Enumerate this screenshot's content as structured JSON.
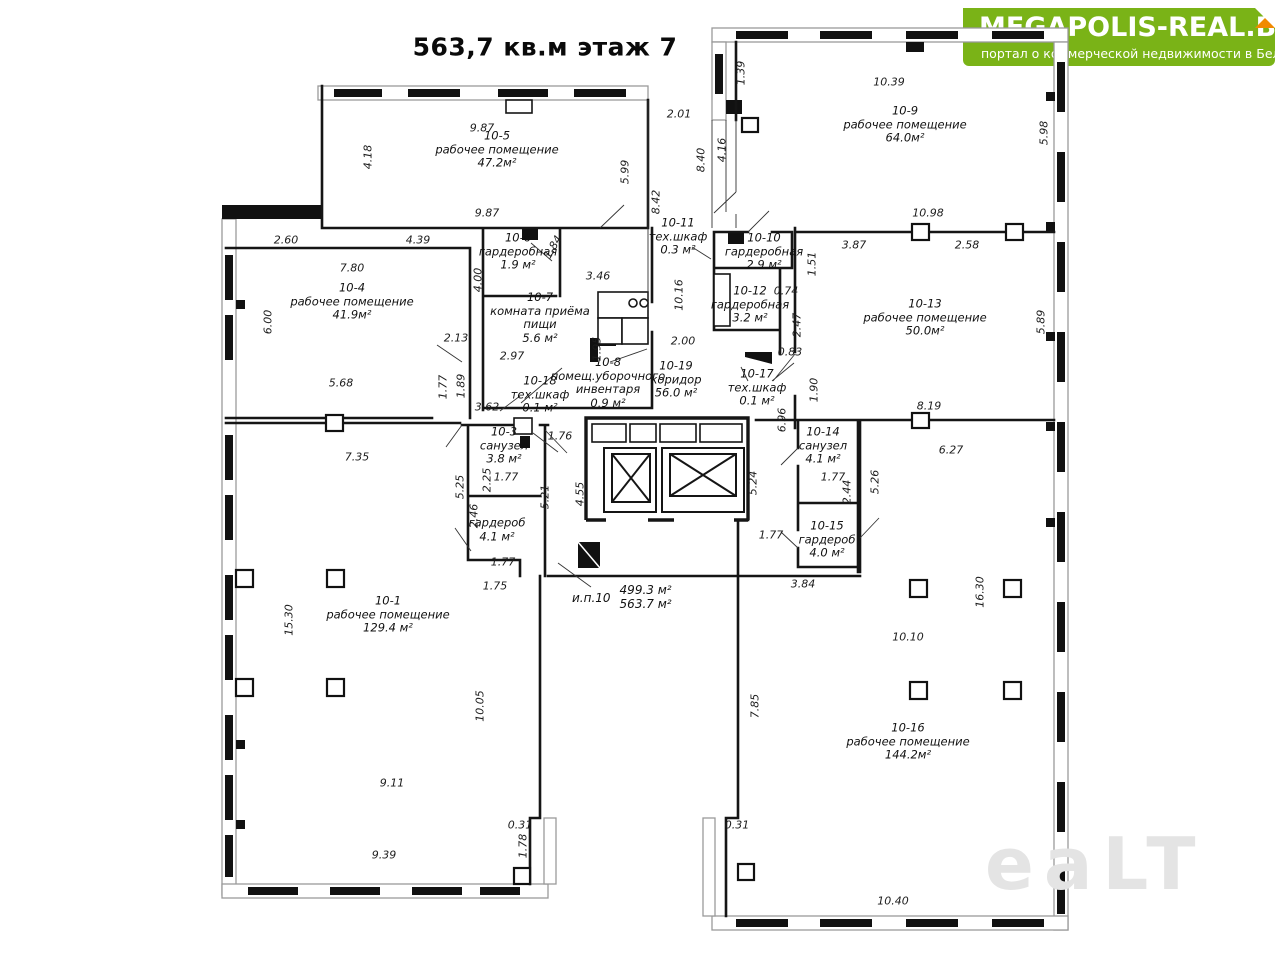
{
  "title": "563,7 кв.м этаж 7",
  "logo": {
    "name": "MEGAPOLIS-REAL.BY",
    "tagline": "портал о коммерческой недвижимости в Беларуси",
    "bg_color": "#7ab317",
    "fold_color": "#f18a00",
    "text_color": "#ffffff"
  },
  "watermark": "eaLT",
  "colors": {
    "wall": "#151515",
    "window_band": "#9a9a9a",
    "watermark_gray": "#e4e4e4"
  },
  "plan": {
    "total": {
      "id": "и.п.10",
      "area_upper": "499.3 м²",
      "area_lower": "563.7 м²"
    },
    "rooms": [
      {
        "id": "10-1",
        "name": "рабочее помещение",
        "area": "129.4 м²",
        "x": 388,
        "y": 615
      },
      {
        "id": "",
        "name": "гардероб",
        "area": "4.1 м²",
        "x": 497,
        "y": 530
      },
      {
        "id": "10-3",
        "name": "санузел",
        "area": "3.8 м²",
        "x": 504,
        "y": 446
      },
      {
        "id": "10-4",
        "name": "рабочее помещение",
        "area": "41.9м²",
        "x": 352,
        "y": 302
      },
      {
        "id": "10-5",
        "name": "рабочее помещение",
        "area": "47.2м²",
        "x": 497,
        "y": 150
      },
      {
        "id": "10-6",
        "name": "гардеробная",
        "area": "1.9 м²",
        "x": 518,
        "y": 252
      },
      {
        "id": "10-7",
        "name": "комната приёма пищи",
        "area": "5.6 м²",
        "x": 540,
        "y": 318,
        "w": 118
      },
      {
        "id": "10-8",
        "name": "помещ.уборочного инвентаря",
        "area": "0.9 м²",
        "x": 608,
        "y": 383,
        "w": 140
      },
      {
        "id": "10-9",
        "name": "рабочее помещение",
        "area": "64.0м²",
        "x": 905,
        "y": 125
      },
      {
        "id": "10-10",
        "name": "гардеробная",
        "area": "2.9 м²",
        "x": 764,
        "y": 252
      },
      {
        "id": "10-11",
        "name": "тех.шкаф",
        "area": "0.3 м²",
        "x": 678,
        "y": 237
      },
      {
        "id": "10-12",
        "name": "гардеробная",
        "area": "3.2 м²",
        "x": 750,
        "y": 305
      },
      {
        "id": "10-13",
        "name": "рабочее помещение",
        "area": "50.0м²",
        "x": 925,
        "y": 318
      },
      {
        "id": "10-14",
        "name": "санузел",
        "area": "4.1 м²",
        "x": 823,
        "y": 446
      },
      {
        "id": "10-15",
        "name": "гардероб",
        "area": "4.0 м²",
        "x": 827,
        "y": 540
      },
      {
        "id": "10-16",
        "name": "рабочее помещение",
        "area": "144.2м²",
        "x": 908,
        "y": 742
      },
      {
        "id": "10-17",
        "name": "тех.шкаф",
        "area": "0.1 м²",
        "x": 757,
        "y": 388
      },
      {
        "id": "10-18",
        "name": "тех.шкаф",
        "area": "0.1 м²",
        "x": 540,
        "y": 395
      },
      {
        "id": "10-19",
        "name": "коридор",
        "area": "56.0 м²",
        "x": 676,
        "y": 380
      }
    ],
    "dimensions": [
      {
        "v": "9.87",
        "x": 482,
        "y": 128,
        "r": 0
      },
      {
        "v": "9.87",
        "x": 487,
        "y": 213,
        "r": 0
      },
      {
        "v": "2.60",
        "x": 286,
        "y": 240,
        "r": 0
      },
      {
        "v": "4.39",
        "x": 418,
        "y": 240,
        "r": 0
      },
      {
        "v": "7.80",
        "x": 352,
        "y": 268,
        "r": 0
      },
      {
        "v": "2.13",
        "x": 456,
        "y": 338,
        "r": 0
      },
      {
        "v": "2.97",
        "x": 512,
        "y": 356,
        "r": 0
      },
      {
        "v": "3.46",
        "x": 598,
        "y": 276,
        "r": 0
      },
      {
        "v": "5.68",
        "x": 341,
        "y": 383,
        "r": 0
      },
      {
        "v": "3.62",
        "x": 487,
        "y": 407,
        "r": 0
      },
      {
        "v": "7.35",
        "x": 357,
        "y": 457,
        "r": 0
      },
      {
        "v": "2.00",
        "x": 683,
        "y": 341,
        "r": 0
      },
      {
        "v": "2.01",
        "x": 679,
        "y": 114,
        "r": 0
      },
      {
        "v": "10.39",
        "x": 889,
        "y": 82,
        "r": 0
      },
      {
        "v": "10.98",
        "x": 928,
        "y": 213,
        "r": 0
      },
      {
        "v": "3.87",
        "x": 854,
        "y": 245,
        "r": 0
      },
      {
        "v": "2.58",
        "x": 967,
        "y": 245,
        "r": 0
      },
      {
        "v": "0.74",
        "x": 786,
        "y": 291,
        "r": 0
      },
      {
        "v": "0.83",
        "x": 790,
        "y": 352,
        "r": 0
      },
      {
        "v": "8.19",
        "x": 929,
        "y": 406,
        "r": 0
      },
      {
        "v": "6.27",
        "x": 951,
        "y": 450,
        "r": 0
      },
      {
        "v": "1.76",
        "x": 560,
        "y": 436,
        "r": 0
      },
      {
        "v": "1.77",
        "x": 506,
        "y": 477,
        "r": 0
      },
      {
        "v": "1.77",
        "x": 503,
        "y": 562,
        "r": 0
      },
      {
        "v": "1.75",
        "x": 495,
        "y": 586,
        "r": 0
      },
      {
        "v": "1.77",
        "x": 833,
        "y": 477,
        "r": 0
      },
      {
        "v": "1.77",
        "x": 771,
        "y": 535,
        "r": 0
      },
      {
        "v": "3.84",
        "x": 803,
        "y": 584,
        "r": 0
      },
      {
        "v": "9.11",
        "x": 392,
        "y": 783,
        "r": 0
      },
      {
        "v": "9.39",
        "x": 384,
        "y": 855,
        "r": 0
      },
      {
        "v": "0.31",
        "x": 520,
        "y": 825,
        "r": 0
      },
      {
        "v": "0.31",
        "x": 737,
        "y": 825,
        "r": 0
      },
      {
        "v": "10.10",
        "x": 908,
        "y": 637,
        "r": 0
      },
      {
        "v": "10.40",
        "x": 893,
        "y": 901,
        "r": 0
      },
      {
        "v": "4.18",
        "x": 368,
        "y": 157,
        "r": 1
      },
      {
        "v": "5.99",
        "x": 625,
        "y": 172,
        "r": 1
      },
      {
        "v": "6.00",
        "x": 268,
        "y": 322,
        "r": 1
      },
      {
        "v": "4.00",
        "x": 478,
        "y": 280,
        "r": 1
      },
      {
        "v": "1.95",
        "x": 597,
        "y": 349,
        "r": 1
      },
      {
        "v": "1.89",
        "x": 461,
        "y": 386,
        "r": 1
      },
      {
        "v": "1.77",
        "x": 443,
        "y": 387,
        "r": 1
      },
      {
        "v": "10.16",
        "x": 679,
        "y": 295,
        "r": 1
      },
      {
        "v": "1.39",
        "x": 741,
        "y": 73,
        "r": 1
      },
      {
        "v": "8.40",
        "x": 701,
        "y": 160,
        "r": 1
      },
      {
        "v": "4.16",
        "x": 722,
        "y": 150,
        "r": 1
      },
      {
        "v": "8.42",
        "x": 656,
        "y": 202,
        "r": 1
      },
      {
        "v": "5.98",
        "x": 1044,
        "y": 133,
        "r": 1
      },
      {
        "v": "1.51",
        "x": 812,
        "y": 264,
        "r": 1
      },
      {
        "v": "2.47",
        "x": 797,
        "y": 325,
        "r": 1
      },
      {
        "v": "1.90",
        "x": 814,
        "y": 390,
        "r": 1
      },
      {
        "v": "5.89",
        "x": 1041,
        "y": 322,
        "r": 1
      },
      {
        "v": "6.96",
        "x": 782,
        "y": 420,
        "r": 1
      },
      {
        "v": "2.25",
        "x": 487,
        "y": 480,
        "r": 1
      },
      {
        "v": "5.25",
        "x": 460,
        "y": 487,
        "r": 1
      },
      {
        "v": "2.46",
        "x": 474,
        "y": 516,
        "r": 1
      },
      {
        "v": "5.21",
        "x": 545,
        "y": 497,
        "r": 1
      },
      {
        "v": "4.55",
        "x": 580,
        "y": 494,
        "r": 1
      },
      {
        "v": "5.24",
        "x": 753,
        "y": 483,
        "r": 1
      },
      {
        "v": "2.44",
        "x": 847,
        "y": 492,
        "r": 1
      },
      {
        "v": "5.26",
        "x": 875,
        "y": 482,
        "r": 1
      },
      {
        "v": "15.30",
        "x": 289,
        "y": 620,
        "r": 1
      },
      {
        "v": "10.05",
        "x": 480,
        "y": 706,
        "r": 1
      },
      {
        "v": "1.78",
        "x": 523,
        "y": 846,
        "r": 1
      },
      {
        "v": "7.85",
        "x": 755,
        "y": 706,
        "r": 1
      },
      {
        "v": "16.30",
        "x": 980,
        "y": 592,
        "r": 1
      },
      {
        "v": "1.84",
        "x": 553,
        "y": 247,
        "r": 2
      }
    ]
  }
}
